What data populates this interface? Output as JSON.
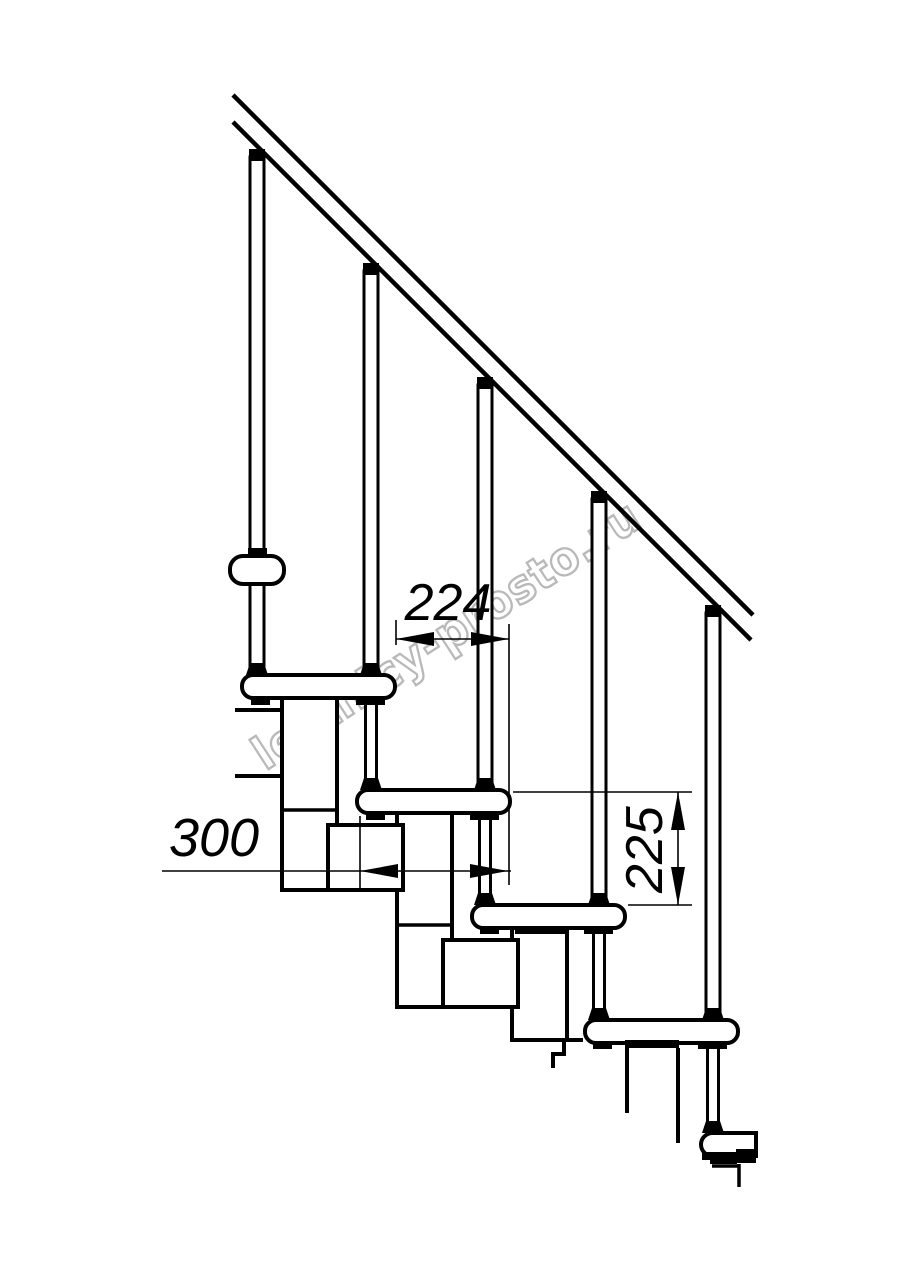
{
  "drawing": {
    "type": "staircase-side-view-technical-drawing",
    "background": "#ffffff",
    "line_color": "#000000",
    "dimensions": {
      "run_label": "224",
      "tread_label": "300",
      "rise_label": "225"
    },
    "watermark": {
      "text": "lestnicy-prosto.ru",
      "color": "#b2b2b2"
    }
  }
}
